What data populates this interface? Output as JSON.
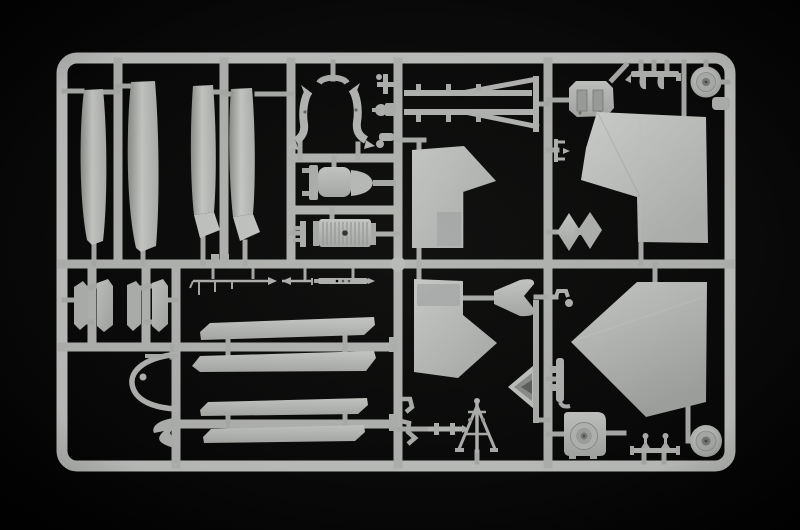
{
  "scene": {
    "type": "photograph",
    "subject": "Injection-molded model kit sprue (parts tree) of light grey styrene plastic photographed on a black background",
    "visible_text": "none"
  },
  "colors": {
    "background": "#0c0c0c",
    "background_edge": "#010101",
    "frame": "#bfc1be",
    "runner": "#b3b5b2",
    "stub": "#acaeab",
    "plastic": "#b8bab7",
    "plastic_bright": "#cdcfcc",
    "plastic_mid": "#b0b2af",
    "plastic_dim": "#9a9c99",
    "hub_dark": "#7b7d7a",
    "detail_dark": "#3c3e3b"
  },
  "sprue": {
    "frame_shape": "rounded rectangle runner frame",
    "frame_bounds": {
      "x": 62,
      "y": 58,
      "width": 668,
      "height": 408
    },
    "parts": [
      {
        "id": "slat-panel-1",
        "desc": "long curved slat panel, vertical"
      },
      {
        "id": "slat-panel-2",
        "desc": "long curved slat panel, vertical"
      },
      {
        "id": "slat-panel-3",
        "desc": "slat panel with angled tip"
      },
      {
        "id": "slat-panel-4",
        "desc": "slat panel with angled tip"
      },
      {
        "id": "exhaust-stack-left",
        "desc": "curved horned stack, left of mirrored pair"
      },
      {
        "id": "exhaust-stack-right",
        "desc": "curved horned stack, right of mirrored pair"
      },
      {
        "id": "pipe-fitting-1",
        "desc": "small T pipe fitting"
      },
      {
        "id": "pipe-fitting-2",
        "desc": "small valve fitting"
      },
      {
        "id": "pipe-fitting-3",
        "desc": "small cylinder fitting"
      },
      {
        "id": "turbine-housing",
        "desc": "rounded housing with bell cone and shaft"
      },
      {
        "id": "ribbed-engine-block",
        "desc": "finned cylinder block"
      },
      {
        "id": "antenna-rod-1",
        "desc": "thin rod with arrow tip and pins"
      },
      {
        "id": "antenna-rod-2",
        "desc": "short rod with arrow head"
      },
      {
        "id": "antenna-rod-3",
        "desc": "flat rail with rivet holes"
      },
      {
        "id": "door-panel-1",
        "desc": "small hexagonal door panel"
      },
      {
        "id": "door-panel-2",
        "desc": "small hexagonal door panel"
      },
      {
        "id": "door-panel-3",
        "desc": "small hexagonal door panel"
      },
      {
        "id": "door-panel-4",
        "desc": "small hexagonal door panel"
      },
      {
        "id": "canopy-bow",
        "desc": "curved D-shaped bow frame with eyelet"
      },
      {
        "id": "anchor-bracket",
        "desc": "small double-fluke bracket"
      },
      {
        "id": "rotor-blade-1",
        "desc": "long flat blade, upper of pair A"
      },
      {
        "id": "rotor-blade-2",
        "desc": "long flat blade, lower of pair A"
      },
      {
        "id": "rotor-blade-3",
        "desc": "long flat blade, upper of pair B"
      },
      {
        "id": "rotor-blade-4",
        "desc": "long flat blade, lower of pair B"
      },
      {
        "id": "boom-frame",
        "desc": "twin-rail boom with diagonal braces"
      },
      {
        "id": "crew-seat",
        "desc": "octagonal seat plate with two recesses"
      },
      {
        "id": "step-bench-top",
        "desc": "bench bar with hanging hooks"
      },
      {
        "id": "road-wheel-top",
        "desc": "round wheel with hub"
      },
      {
        "id": "corner-tab",
        "desc": "small rounded tab"
      },
      {
        "id": "c-bracket",
        "desc": "small C bracket"
      },
      {
        "id": "diamond-fairing-pair",
        "desc": "two diamond fairings"
      },
      {
        "id": "fin-upper-center",
        "desc": "flag-shaped fin panel"
      },
      {
        "id": "fin-upper-right",
        "desc": "large tail fin with rudder step"
      },
      {
        "id": "fin-lower-center",
        "desc": "flag-shaped fin panel, mirrored"
      },
      {
        "id": "fin-lower-right",
        "desc": "large pentagonal fin panel"
      },
      {
        "id": "bell-funnel",
        "desc": "bell-mouth funnel"
      },
      {
        "id": "nose-cone",
        "desc": "hollow cone seen from rear"
      },
      {
        "id": "link-bar",
        "desc": "vertical link runner"
      },
      {
        "id": "hook-bracket",
        "desc": "small Z hook with boss"
      },
      {
        "id": "latch-bracket",
        "desc": "latch bar with side nubs"
      },
      {
        "id": "winch-tripod",
        "desc": "tripod mast with legs and crossbars"
      },
      {
        "id": "axle-rod",
        "desc": "stepped axle rod with collars"
      },
      {
        "id": "hook-small-1",
        "desc": "tiny bent hook"
      },
      {
        "id": "hook-small-2",
        "desc": "tiny bent bracket"
      },
      {
        "id": "sensor-pod",
        "desc": "rounded pod with concentric rings"
      },
      {
        "id": "step-bench-bottom",
        "desc": "bench bar with candlestick posts"
      },
      {
        "id": "road-wheel-bottom",
        "desc": "round wheel with hub"
      },
      {
        "id": "junction-ball",
        "desc": "spherical runner junction"
      }
    ]
  }
}
